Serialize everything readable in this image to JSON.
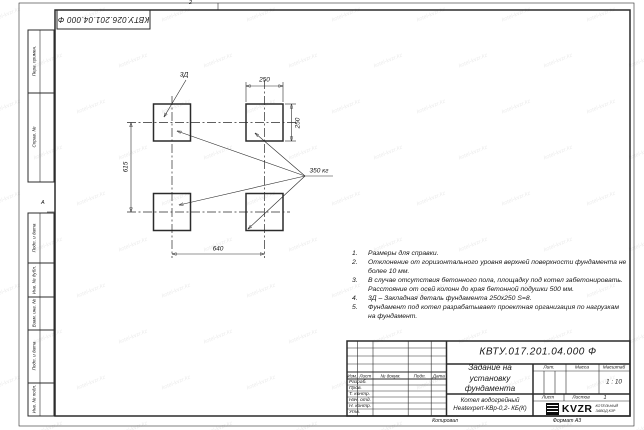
{
  "sheet": {
    "top_stamp": "КВТУ.026.201.04.000 Ф",
    "zone_top": "2",
    "zone_left": "А",
    "footer": {
      "copied": "Копировал",
      "format": "Формат А3"
    },
    "watermark": "kotel-kvzr.kz"
  },
  "margin_labels": {
    "perv": "Перв. примен.",
    "sprav": "Справ. №",
    "podp1": "Подп. и дата",
    "inv_dubl": "Инв. № дубл.",
    "vzam": "Взам. инв. №",
    "podp2": "Подп. и дата",
    "inv_podl": "Инв. № подл."
  },
  "drawing": {
    "dim_top": "250",
    "dim_right": "250",
    "dim_left": "615",
    "dim_bottom": "640",
    "embed_label": "3Д",
    "mass_label": "350 кг"
  },
  "notes": {
    "items": [
      {
        "n": "1.",
        "text": "Размеры для справки."
      },
      {
        "n": "2.",
        "text": "Отклонение от горизонтального уровня верхней поверхности фундамента не более 10 мм."
      },
      {
        "n": "3.",
        "text": "В случае отсутствия бетонного пола, площадку под котел забетонировать. Расстояние от осей колонн до края бетонной подушки 500 мм."
      },
      {
        "n": "4.",
        "text": "3Д – Закладная деталь фундамента 250х250 S=8."
      },
      {
        "n": "5.",
        "text": "Фундамент под котел разрабатывает проектная организация по нагрузкам на фундамент."
      }
    ]
  },
  "title_block": {
    "doc_number": "КВТУ.017.201.04.000 Ф",
    "doc_title_line1": "Задание на установку",
    "doc_title_line2": "фундамента",
    "header": {
      "izm": "Изм.",
      "list": "Лист",
      "doc": "№ докум.",
      "podp": "Подп.",
      "data": "Дата"
    },
    "rows": [
      "Разраб.",
      "Пров.",
      "Т. контр.",
      "Нач. отд.",
      "Н. контр.",
      "Утв."
    ],
    "lit": "Лит.",
    "mass": "Масса",
    "scale_label": "Масштаб",
    "scale": "1 : 10",
    "sheet_label": "Лист",
    "sheets_label": "Листов",
    "sheets_value": "1",
    "product_line1": "Котел водогрейный",
    "product_line2": "Heatexpert-КВр-0,2- КБ(К)",
    "logo": "KVZR",
    "logo_sub1": "КОТЕЛЬНЫЙ",
    "logo_sub2": "ЗАВОД КЗР"
  }
}
